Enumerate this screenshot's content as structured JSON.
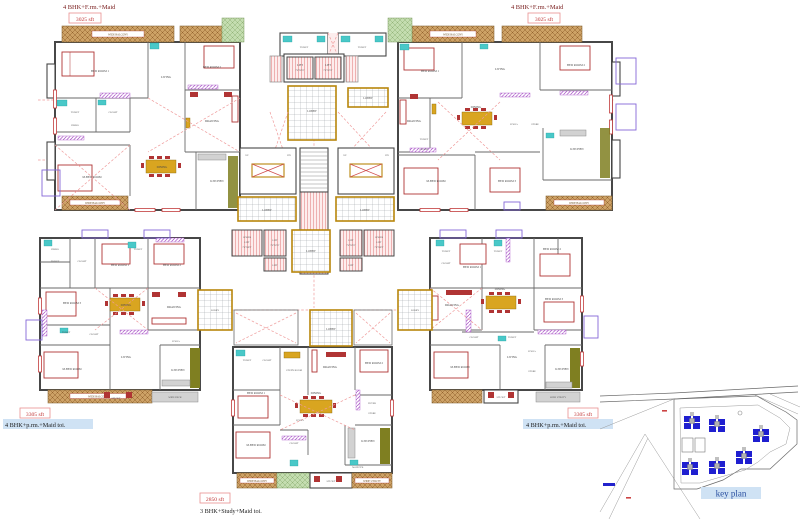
{
  "units": {
    "top_left": {
      "type_label": "4 BHK+F.rm.+Maid",
      "area": "3025 sft"
    },
    "top_right": {
      "type_label": "4 BHK+F.rm.+Maid",
      "area": "3025 sft"
    },
    "mid_left": {
      "type_label": "4 BHK+p.rm.+Maid toi.",
      "area": "3305 sft"
    },
    "mid_right": {
      "type_label": "4 BHK+p.rm.+Maid toi.",
      "area": "3305 sft"
    },
    "bottom": {
      "type_label": "3 BHK+Study+Maid toi.",
      "area": "2850 sft"
    }
  },
  "core": {
    "lift": "LIFT",
    "lift_size": "7'6\"X7'6\"",
    "goods_1": "GOODS",
    "goods_2": "LIFT",
    "goods_size": "7'6\"X9'9\"",
    "lobby": "LOBBY",
    "corridor": "WIDE CORRIDOR",
    "toilet": "TOILET",
    "up": "UP",
    "dn": "DN"
  },
  "rooms": {
    "bed1": "BED ROOM 1",
    "bed2": "BED ROOM 2",
    "bed3": "BED ROOM 3",
    "mbed": "M.BED ROOM",
    "drawing": "DRAWING",
    "dining": "DINING",
    "living": "LIVING",
    "kitchen": "KITCHEN",
    "closet": "CLOSET",
    "toilet": "TOILET",
    "dress": "DRESS",
    "pooja": "POOJA",
    "store": "STORE",
    "foyer": "FOYER",
    "study": "STUDY ROOM",
    "maid": "MAID TOI.",
    "sitout": "SIT OUT",
    "balcony": "WIDE BALCONY",
    "utility": "WIDE UTILITY",
    "deck": "WIDE DECK"
  },
  "key_plan": {
    "label": "key plan"
  },
  "colors": {
    "wall": "#474747",
    "balcony_tan": "#cda266",
    "balcony_green": "#c4ddb0",
    "lift_pink": "#eeb0b0",
    "lobby_gold": "#b8860b",
    "accent_red": "#b03434",
    "toilet_cyan": "#49c8c8",
    "wardrobe_purple": "#a74fc6",
    "kitchen_olive": "#7f7f21",
    "dashed_red": "#ef9a9a",
    "type_label_red": "#7b2020",
    "area_box_red": "#c03535",
    "highlight_blue": "#cfe2f4",
    "keyplan_building_blue": "#1f1fd0",
    "keyplan_text_blue": "#2a4fa0"
  }
}
